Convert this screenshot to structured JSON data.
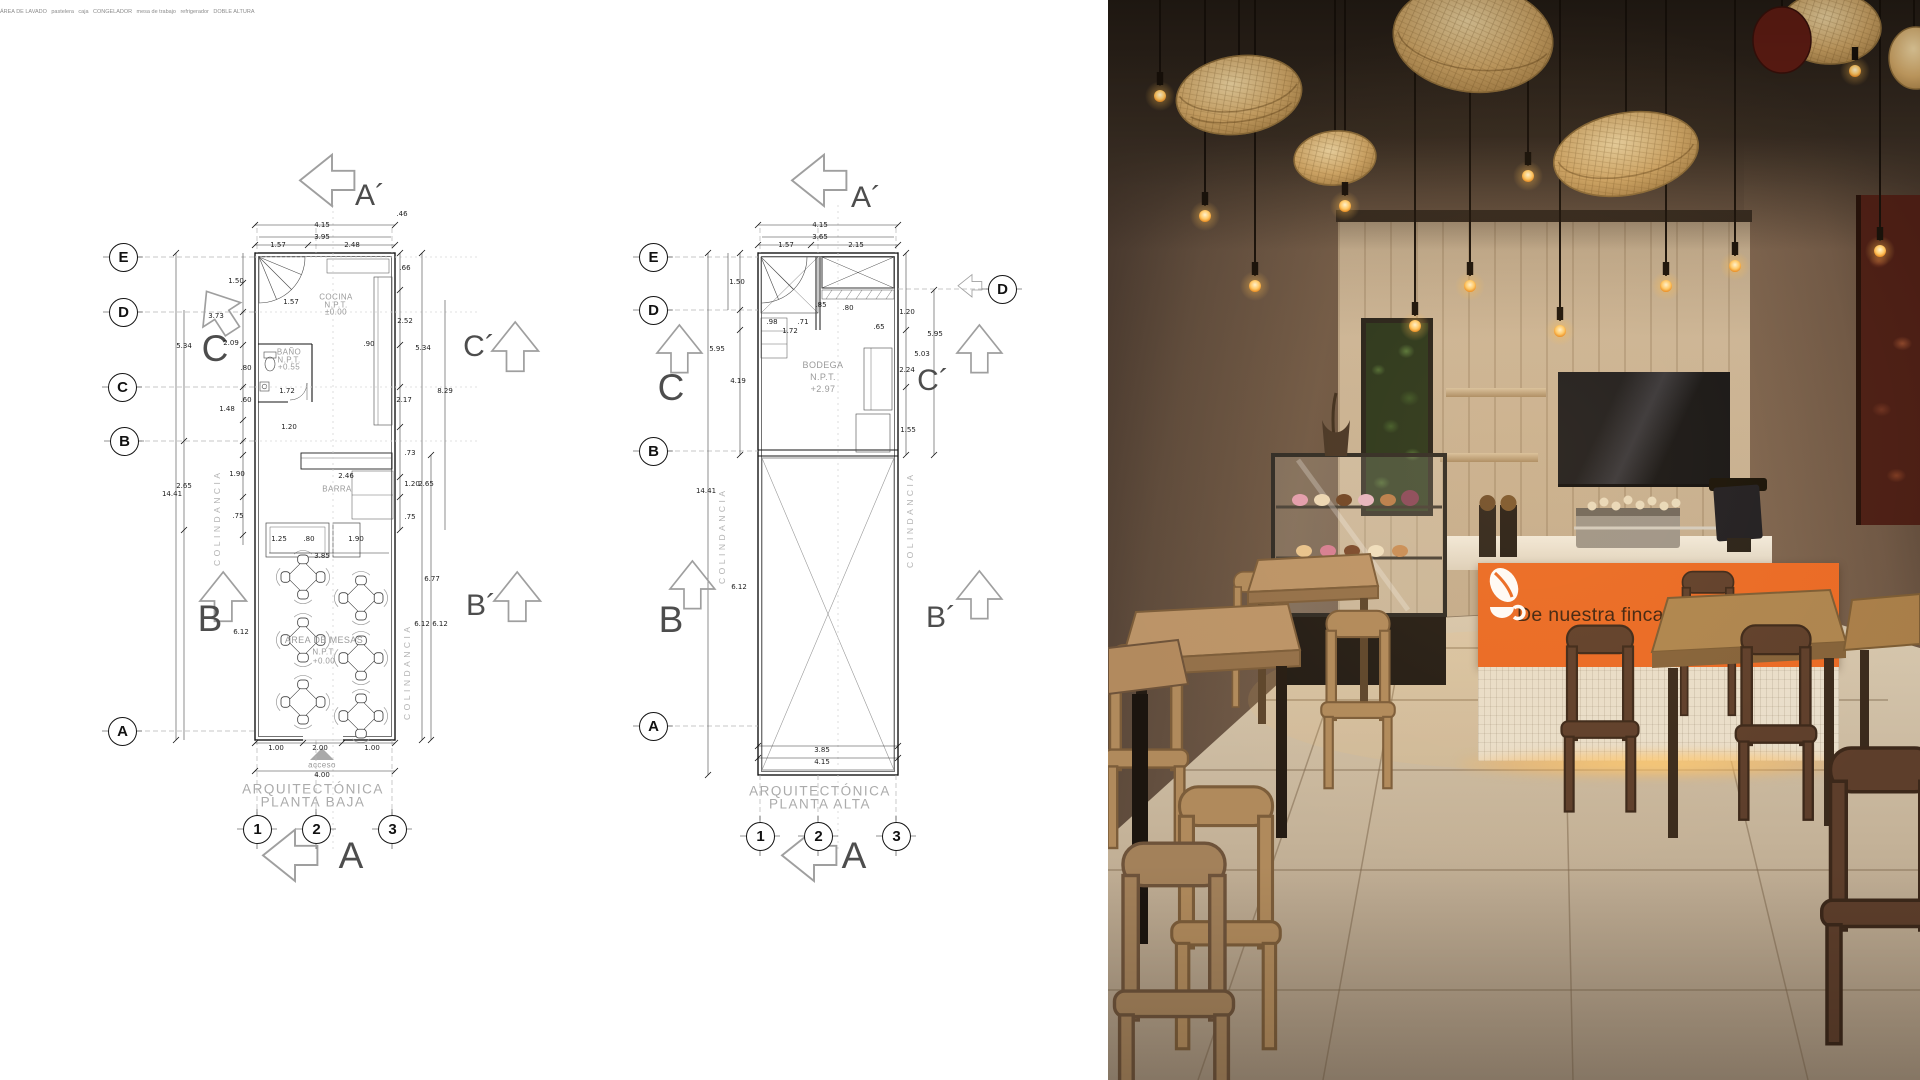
{
  "colors": {
    "banner_orange": "#EA6A25",
    "slogan_text": "#3F2310",
    "moss_green": "#4C6B34",
    "rattan_lamp": "#C9A265",
    "wood_wall": "#C2AB8D"
  },
  "plan_baja": {
    "title": [
      "ARQUITECTÓNICA",
      "PLANTA BAJA"
    ],
    "grid_rows": [
      "E",
      "D",
      "C",
      "B",
      "A"
    ],
    "grid_cols": [
      "1",
      "2",
      "3"
    ],
    "sections": {
      "a_top": "A´",
      "c_left": "C",
      "c_right": "C´",
      "b_left": "B",
      "b_right": "B´",
      "a_bottom": "A"
    },
    "boundary_label": "COLINDANCIA",
    "entry_label": "acceso",
    "rooms": {
      "cocina": [
        "COCINA",
        "N.P.T.",
        "±0.00"
      ],
      "bano": [
        "BAÑO",
        "N.P.T.",
        "+0.55"
      ],
      "area_mesas": [
        "ÁREA DE MESAS",
        "N.P.T.",
        "+0.00"
      ],
      "barra": "BARRA",
      "area_lavado": "ÁREA DE LAVADO",
      "pastelera": "pastelera",
      "caja": "caja"
    },
    "dims": [
      "4.15",
      "3.95",
      "1.57",
      "2.48",
      "1.50",
      "3.73",
      "2.09",
      "5.34",
      ".80",
      "1.48",
      ".60",
      "1.90",
      ".75",
      "2.65",
      "14.41",
      "6.12",
      ".46",
      ".66",
      "2.52",
      "5.34",
      "8.29",
      "2.17",
      ".73",
      "1.20",
      "2.65",
      ".75",
      "6.77",
      "6.12",
      "6.12",
      "1.57",
      ".90",
      "1.72",
      "1.20",
      "2.46",
      "1.25",
      ".80",
      "1.90",
      "3.85",
      "1.00",
      "2.00",
      "1.00",
      "4.00"
    ]
  },
  "plan_alta": {
    "title": [
      "ARQUITECTÓNICA",
      "PLANTA ALTA"
    ],
    "grid_rows": [
      "E",
      "D",
      "B",
      "A"
    ],
    "grid_row_right": "D",
    "grid_cols": [
      "1",
      "2",
      "3"
    ],
    "sections": {
      "a_top": "A´",
      "c_left": "C",
      "c_right": "C´",
      "b_left": "B",
      "b_right": "B´",
      "a_bottom": "A"
    },
    "boundary_label": "COLINDANCIA",
    "rooms": {
      "bodega": [
        "BODEGA",
        "N.P.T.",
        "+2.97"
      ],
      "congelador": "CONGELADOR",
      "mesa_trabajo": "mesa de trabajo",
      "refrigerador": "refrigerador",
      "doble_altura": "DOBLE ALTURA"
    },
    "dims": [
      "4.15",
      "3.65",
      "1.57",
      "2.15",
      "1.50",
      "5.95",
      "4.19",
      "14.41",
      "6.12",
      "1.20",
      "5.95",
      "5.03",
      "2.24",
      "1.55",
      ".98",
      "1.72",
      ".71",
      ".85",
      ".80",
      ".65",
      "3.85",
      "4.15"
    ]
  },
  "render": {
    "banner": {
      "slogan": "De nuestra finca a tu taza"
    }
  }
}
